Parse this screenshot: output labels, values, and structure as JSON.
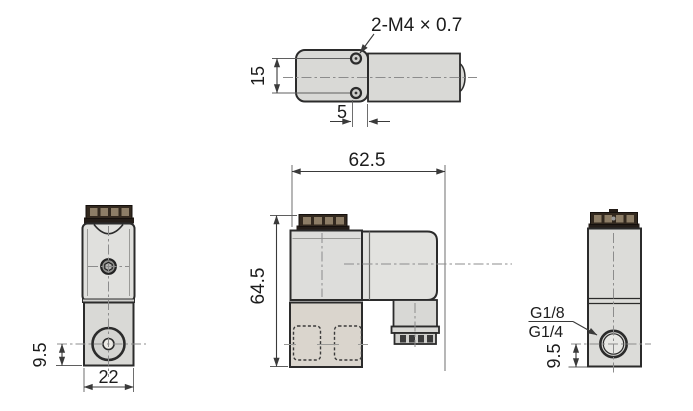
{
  "drawing": {
    "type": "solenoid-valve-dimension-drawing",
    "views": {
      "top": {
        "thread_callout": "2-M4 × 0.7",
        "hole_spacing_mm": "15",
        "hole_edge_offset_mm": "5"
      },
      "front": {
        "port_center_height_mm": "9.5",
        "body_width_mm": "22"
      },
      "side": {
        "overall_width_mm": "62.5",
        "overall_height_mm": "64.5"
      },
      "back": {
        "thread_option_1": "G1/8",
        "thread_option_2": "G1/4",
        "port_center_height_mm": "9.5"
      }
    },
    "colors": {
      "background": "#ffffff",
      "part_fill": "#d9d9d6",
      "part_fill_light": "#e2e2df",
      "part_fill_warm": "#dad5cd",
      "cap_fill": "#33291f",
      "cap_base": "#241d18",
      "cap_slot": "#8d7d66",
      "outline": "#2b2b2b",
      "centerline": "#8c8c8c",
      "dimension": "#3a3a3a"
    }
  }
}
